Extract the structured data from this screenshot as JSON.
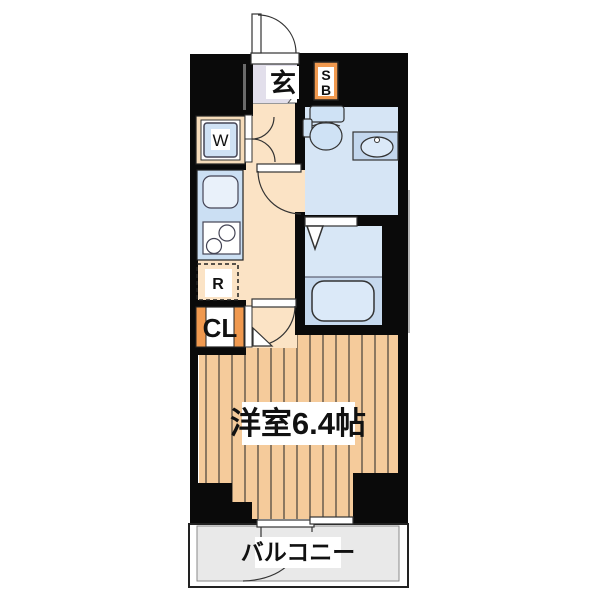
{
  "plan": {
    "labels": {
      "entrance": "玄",
      "shoe_box_line1": "S",
      "shoe_box_line2": "B",
      "washing_machine": "W",
      "refrigerator": "R",
      "closet": "CL",
      "main_room": "洋室6.4帖",
      "balcony": "バルコニー"
    },
    "colors": {
      "wall": "#0a0a0a",
      "corridor_floor": "#fbe3c5",
      "entrance_floor": "#e2dfeb",
      "wood_floor": "#f5cb9b",
      "wood_stripe": "#46403a",
      "wet_area_floor": "#d6e5f5",
      "bath_floor": "#d8e7f6",
      "tub_zone": "#c6d9ee",
      "tub_fill": "#dbe9f8",
      "fixture_blue": "#cfe2f5",
      "counter_blue": "#cbdff3",
      "sink_white": "#e9f1fa",
      "vanity_blue": "#c3d7ee",
      "accent_orange": "#f0994f",
      "closet_frame_tan": "#f6dcba",
      "balcony_floor": "#e9e9e9"
    }
  }
}
